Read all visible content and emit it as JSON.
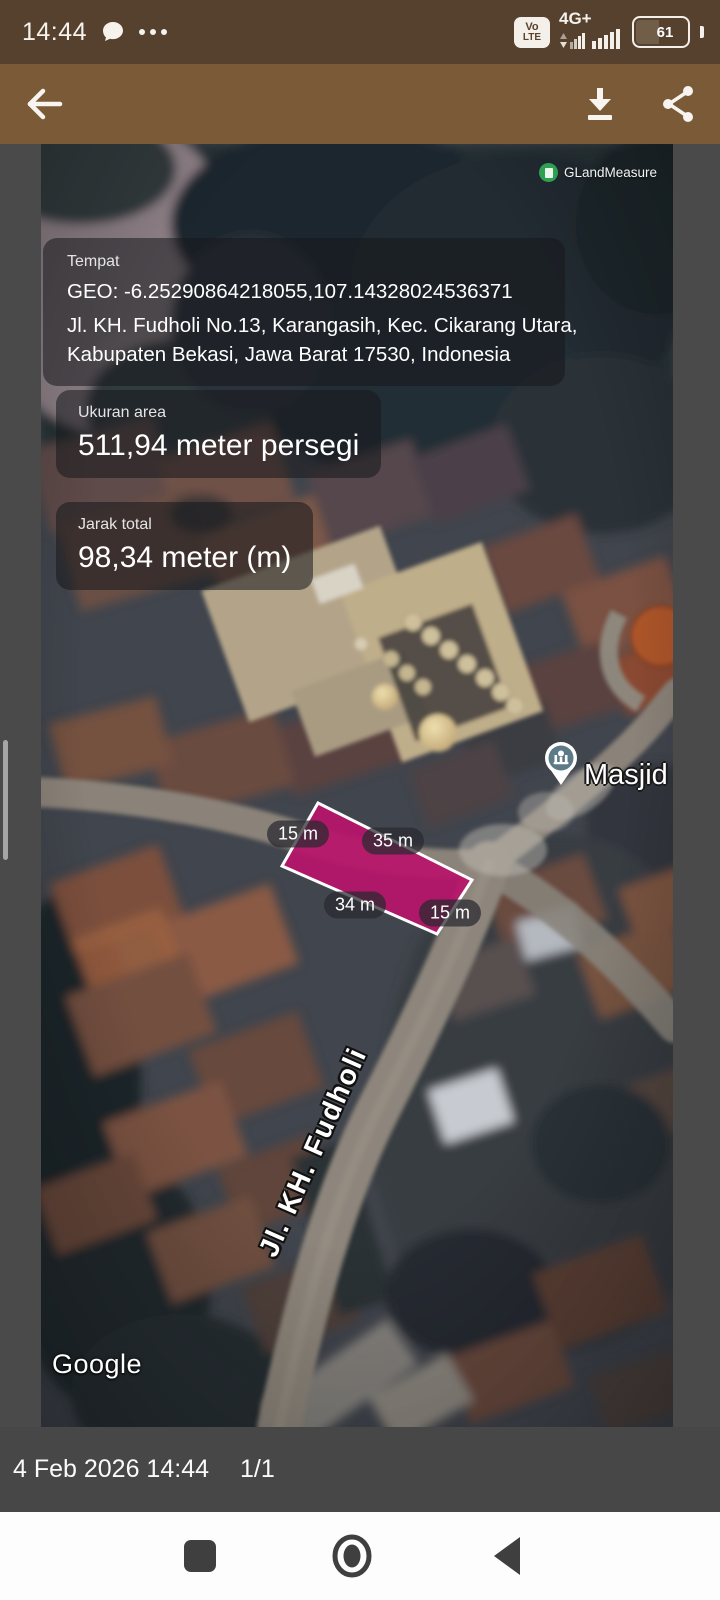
{
  "status_bar": {
    "time": "14:44",
    "network_type": "4G+",
    "volte_top": "Vo",
    "volte_bottom": "LTE",
    "battery_percent": "61"
  },
  "map": {
    "watermark": "GLandMeasure",
    "provider": "Google",
    "poi_label": "Masjid J",
    "street_label": "Jl. KH. Fudholi",
    "place_card": {
      "label": "Tempat",
      "geo": "GEO: -6.25290864218055,107.14328024536371",
      "address_line1": "Jl. KH. Fudholi No.13, Karangasih, Kec. Cikarang Utara,",
      "address_line2": "Kabupaten Bekasi, Jawa Barat 17530, Indonesia"
    },
    "area_card": {
      "label": "Ukuran area",
      "value": "511,94 meter persegi"
    },
    "distance_card": {
      "label": "Jarak total",
      "value": "98,34 meter (m)"
    },
    "measurements": [
      "15 m",
      "35 m",
      "34 m",
      "15 m"
    ],
    "colors": {
      "parcel_fill": "#b8146a",
      "parcel_stroke": "#ffffff"
    }
  },
  "viewer": {
    "footer_datetime": "4 Feb 2026 14:44",
    "footer_page": "1/1"
  }
}
